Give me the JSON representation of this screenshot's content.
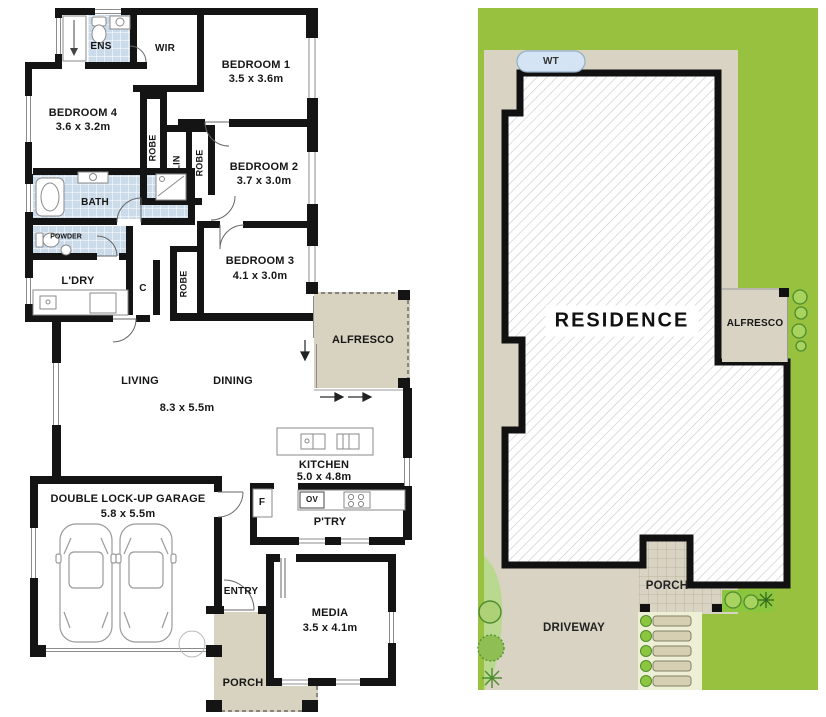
{
  "floor_plan": {
    "ens": "ENS",
    "wir": "WIR",
    "bedroom1": {
      "name": "BEDROOM 1",
      "dims": "3.5 x 3.6m"
    },
    "bedroom2": {
      "name": "BEDROOM 2",
      "dims": "3.7 x 3.0m"
    },
    "bedroom3": {
      "name": "BEDROOM 3",
      "dims": "4.1 x 3.0m"
    },
    "bedroom4": {
      "name": "BEDROOM 4",
      "dims": "3.6 x 3.2m"
    },
    "robe": "ROBE",
    "lin": "LIN",
    "bath": "BATH",
    "powder": "POWDER",
    "laundry": "L'DRY",
    "cupboard": "C",
    "alfresco": "ALFRESCO",
    "living": "LIVING",
    "dining": "DINING",
    "living_dining_dims": "8.3 x 5.5m",
    "kitchen": {
      "name": "KITCHEN",
      "dims": "5.0 x 4.8m"
    },
    "oven": "OV",
    "fridge": "F",
    "pantry": "P'TRY",
    "garage": {
      "name": "DOUBLE LOCK-UP GARAGE",
      "dims": "5.8 x 5.5m"
    },
    "entry": "ENTRY",
    "media": {
      "name": "MEDIA",
      "dims": "3.5 x 4.1m"
    },
    "porch": "PORCH"
  },
  "site_plan": {
    "water_tank": "WT",
    "residence": "RESIDENCE",
    "alfresco": "ALFRESCO",
    "porch": "PORCH",
    "driveway": "DRIVEWAY"
  },
  "colors": {
    "wall": "#141414",
    "tile_blue": "#ccdbea",
    "outdoor_tan": "#d8d2c0",
    "site_lot_tan": "#d8d3c2",
    "lawn_green": "#97c13e",
    "garden_light_green": "#b9da8e",
    "shrub_green": "#a8d35e",
    "shrub_outline": "#4e8c2d",
    "water_tank_blue": "#d4e4f4",
    "hatch_gray": "#cccccc"
  }
}
